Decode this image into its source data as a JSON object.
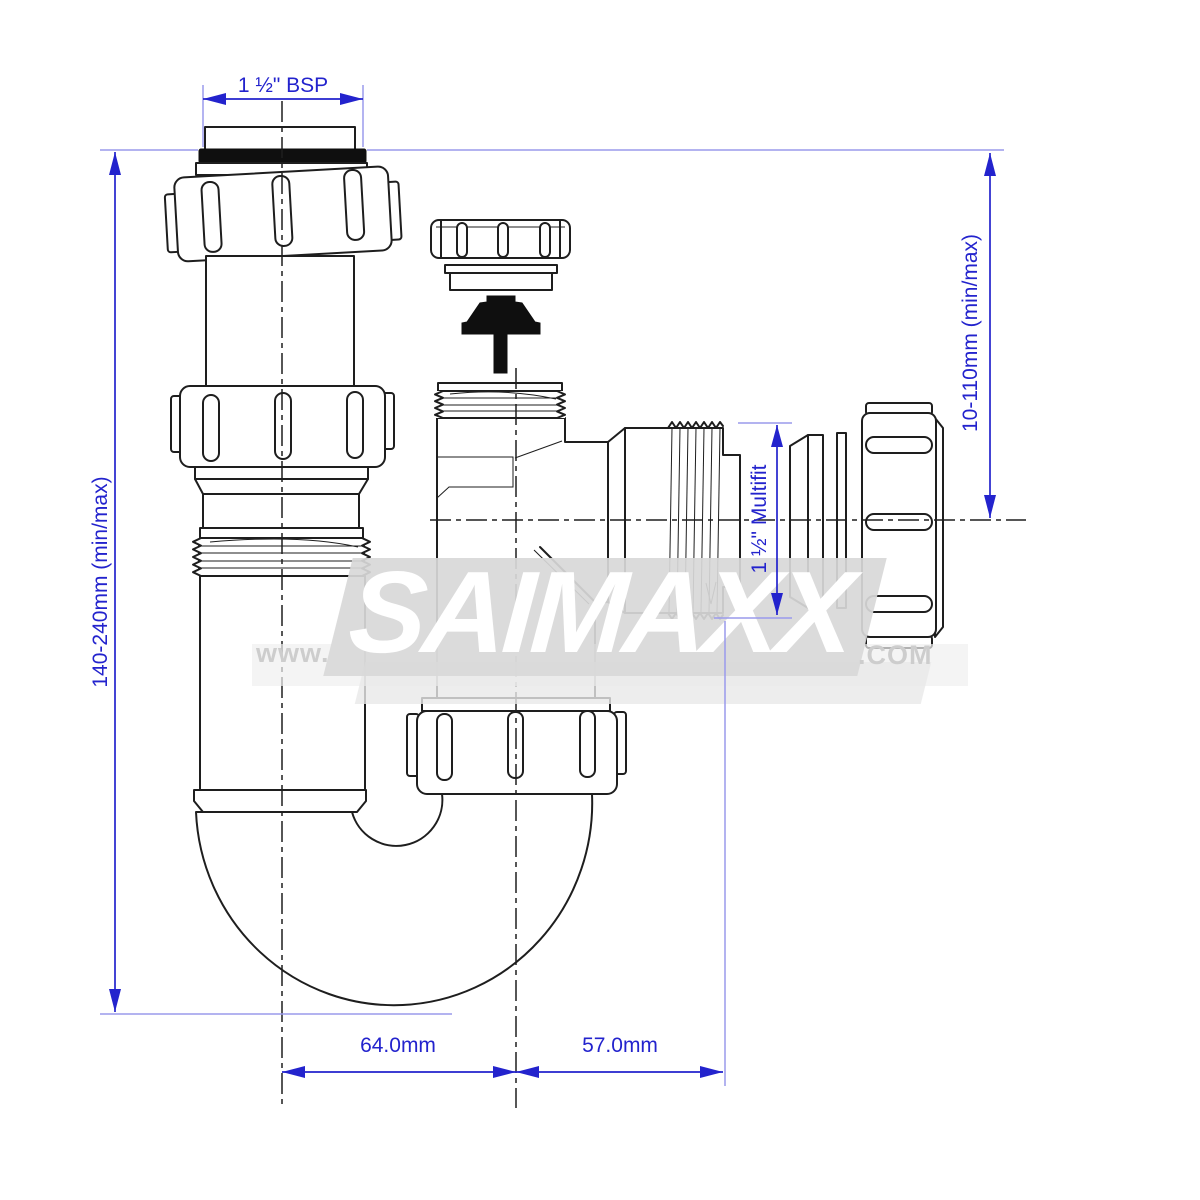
{
  "dimensions": {
    "top_width": "1 ½\" BSP",
    "left_height": "140-240mm (min/max)",
    "right_height": "10-110mm (min/max)",
    "outlet_size": "1 ½\" Multifit",
    "bottom_left_width": "64.0mm",
    "bottom_right_width": "57.0mm"
  },
  "watermark": {
    "prefix": "www.",
    "brand": "SAIMAXX",
    "suffix": ".COM"
  },
  "colors": {
    "dimension_blue": "#2323cd",
    "extension_blue": "#9a9aec",
    "drawing_line": "#1e1e1e",
    "watermark_band": "#d8d8d8",
    "watermark_text": "#ffffff",
    "watermark_gray": "#cdcdcd"
  }
}
